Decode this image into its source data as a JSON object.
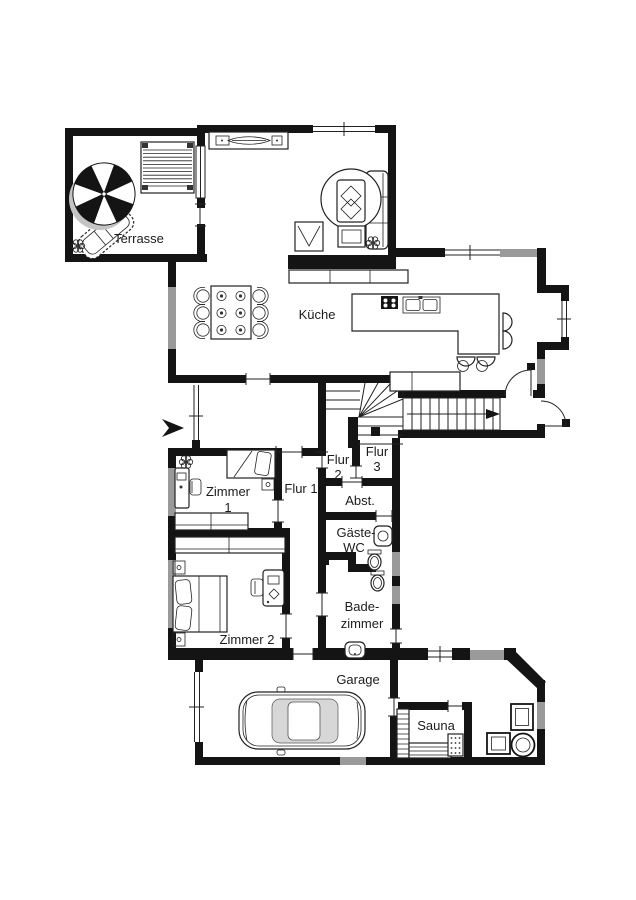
{
  "rooms": {
    "terrasse": "Terrasse",
    "kueche": "Küche",
    "flur1": "Flur 1",
    "flur2": [
      "Flur",
      "2"
    ],
    "flur3": [
      "Flur",
      "3"
    ],
    "abstellraum": "Abst.",
    "gaeste_wc": [
      "Gäste-",
      "WC"
    ],
    "badezimmer": [
      "Bade-",
      "zimmer"
    ],
    "zimmer1": [
      "Zimmer",
      "1"
    ],
    "zimmer2": "Zimmer 2",
    "garage": "Garage",
    "sauna": "Sauna"
  },
  "colors": {
    "wall": "#141414",
    "window": "#9a9a9a",
    "background": "#ffffff",
    "text": "#1c1c1c",
    "car_glass": "#d7d7d7"
  },
  "icons": [
    "parasol-icon",
    "sun-lounger-icon",
    "slatted-bench-icon",
    "plant-icon",
    "sideboard-icon",
    "sofa-icon",
    "armchair-icon",
    "side-table-icon",
    "dining-table-icon",
    "dining-chair-icon",
    "plate-icon",
    "kitchen-counter-icon",
    "kitchen-island-icon",
    "cooktop-icon",
    "sink-icon",
    "bar-stool-icon",
    "winder-staircase-icon",
    "straight-staircase-icon",
    "stair-direction-arrow-icon",
    "entrance-arrow-icon",
    "door-swing-icon",
    "window-icon",
    "single-bed-icon",
    "double-bed-icon",
    "desk-icon",
    "desk-chair-icon",
    "wardrobe-icon",
    "nightstand-icon",
    "toilet-icon",
    "washbasin-icon",
    "shower-icon",
    "car-icon",
    "garage-door-icon",
    "sauna-bench-icon",
    "sauna-heater-icon",
    "lounge-chair-icon",
    "hot-tub-icon"
  ]
}
